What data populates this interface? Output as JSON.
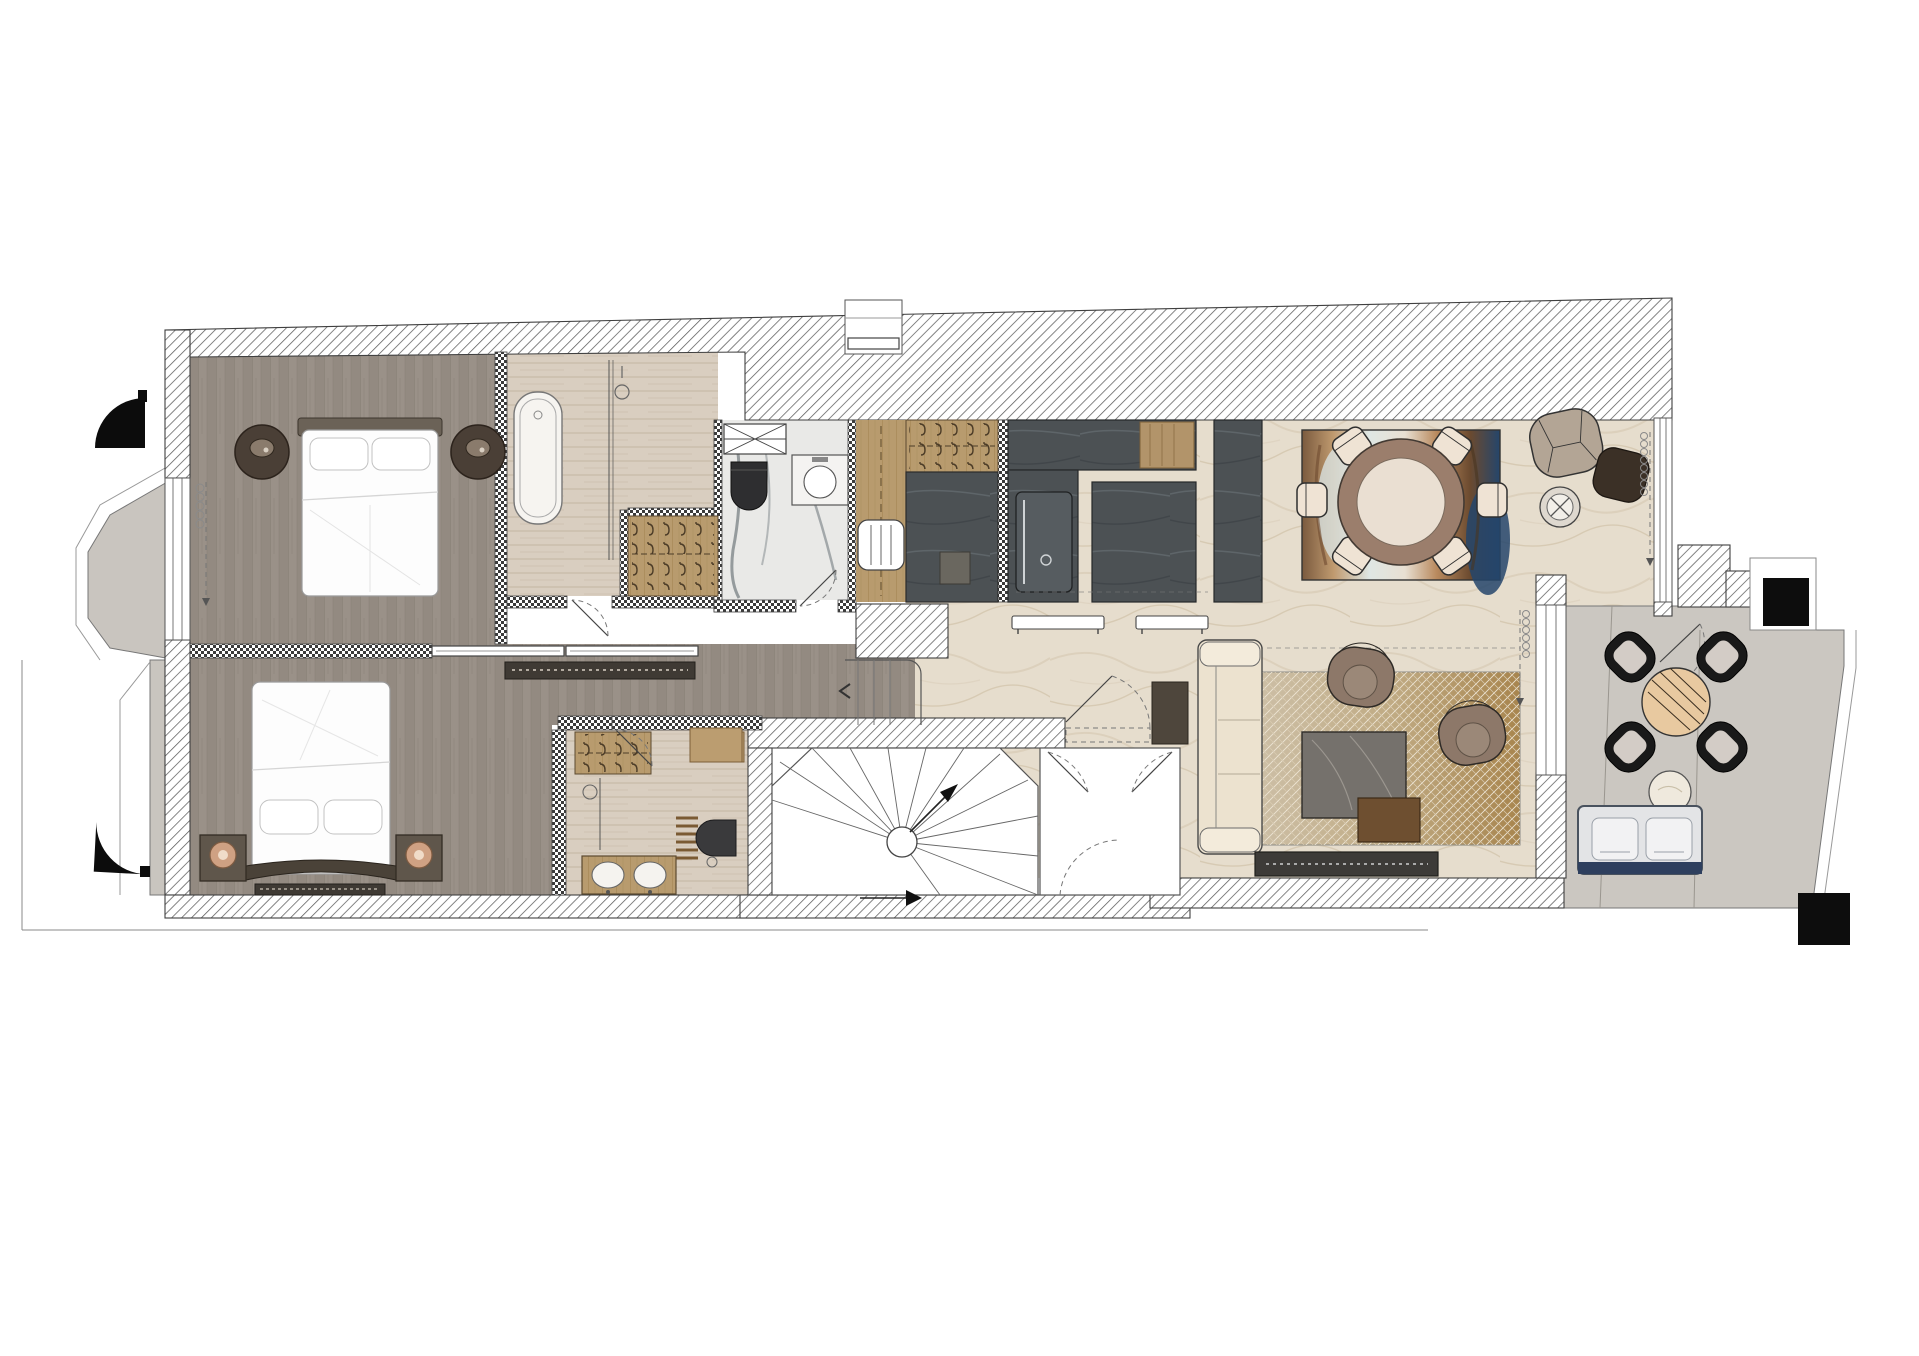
{
  "meta": {
    "title": "Furnished apartment floor plan — top-down interior design drawing",
    "type": "architectural-floor-plan",
    "visible_text": "none"
  },
  "palette": {
    "background": "#ffffff",
    "wall_hatch_line": "#5b5b5b",
    "wall_outline": "#3f3f3f",
    "oak_floor": "#9a9188",
    "oak_floor_line": "#837a71",
    "travertine": "#d9cec0",
    "marble_white": "#e9e9e7",
    "marble_vein": "#5e676d",
    "limestone_living": "#e6ddcd",
    "terrace_stone": "#cbc7c1",
    "kitchen_dark": "#4c5154",
    "closet_wood": "#b89b6e",
    "cabinet_dark": "#55524c",
    "rug_gold": "#a8854e",
    "rug_navy": "#2f4f73",
    "bench_navy": "#2e3f5e",
    "chair_cream": "#efe3d4",
    "armchair_brown": "#8d7869",
    "nightstand_brown": "#4a3f36",
    "black_elements": "#111111"
  },
  "rooms": {
    "bedroom1": {
      "label": "Bedroom 1",
      "floor": "oak planks"
    },
    "bathroom1": {
      "label": "Bathroom 1",
      "floor": "travertine"
    },
    "wardrobe1": {
      "label": "Walk-in wardrobe",
      "floor": "wood"
    },
    "wc": {
      "label": "Guest WC",
      "floor": "marble"
    },
    "entry": {
      "label": "Entrance hall",
      "floor": "wood"
    },
    "kitchen": {
      "label": "Kitchen",
      "floor": "limestone"
    },
    "dining": {
      "label": "Dining area",
      "floor": "limestone"
    },
    "lounge": {
      "label": "Reading corner",
      "floor": "limestone"
    },
    "corridor": {
      "label": "Corridor",
      "floor": "oak planks"
    },
    "bedroom2": {
      "label": "Bedroom 2",
      "floor": "oak planks"
    },
    "bathroom2": {
      "label": "Bathroom 2",
      "floor": "travertine"
    },
    "stairhall": {
      "label": "Spiral stair hall",
      "floor": "screed"
    },
    "vestibule": {
      "label": "Stair vestibule",
      "floor": "screed"
    },
    "living": {
      "label": "Living room",
      "floor": "limestone"
    },
    "terrace": {
      "label": "Terrace",
      "floor": "stone"
    },
    "bay": {
      "label": "Bay balcony",
      "floor": "stone"
    }
  },
  "furniture": {
    "bed1": "Double bed with headboard and two pillows",
    "nightstands_round": "2 round dark-wood nightstands with table lamps",
    "bathtub": "Freestanding oval bathtub",
    "shower1": "Walk-in shower with glass screen",
    "closet_hangers": "Wardrobe with clothes-hanger rows",
    "wc_radiator": "Radiator panel (X symbol)",
    "wc_toilet": "Wall-hung toilet (black)",
    "wc_basin": "Washbasin cabinet with round bowl",
    "towel_radiator": "Towel radiator (white, 3 bars)",
    "coat_closet": "Entry coat closet with hanger row",
    "entry_cabinet": "Tall dark entry cabinet",
    "kitchen_counter": "L-shaped dark stone counter with wood chopping section",
    "oven": "Built-in appliance front with handle",
    "island": "Kitchen island (dark stone)",
    "tall_cabinet": "Tall kitchen cabinet column",
    "wall_shelves": "2 white wall-mounted shelves",
    "dining_table": "Round two-tone dining table",
    "dining_chairs_count": 6,
    "dining_rug": "Abstract rug in blue / white / brown tones",
    "lounge_chair": "Curved lounge armchair (beige)",
    "ottoman": "Dark brown ottoman",
    "side_table_x": "Round side table with X-base",
    "sofa": "Three-seat cream sofa",
    "armchairs_count": 2,
    "coffee_table_marble": "Marble coffee table",
    "coffee_table_wood": "Nesting wood coffee table",
    "living_rug": "Gold cross-hatch pattern rug",
    "tv_console": "Low dark media console",
    "door_mat": "Dark door mat",
    "bed2": "King bed with curved headboard",
    "nightstands_square": "2 square nightstands with round lamps",
    "vanity2": "Double-sink wood vanity",
    "toilet2": "Wall-hung toilet (dark)",
    "towel_ladder": "Towel ladder rack",
    "trench_heater": "Floor trench heater grille",
    "console_dark": "Low dark console with ticks",
    "pocket_doors": "Double pocket sliding doors",
    "spiral_stair": "Winder spiral staircase with newel",
    "terrace_table": "Round striped-wood terrace table",
    "terrace_chairs_count": 4,
    "terrace_bench": "Outdoor bench with 2 cushions on navy base",
    "terrace_side_table": "Round outdoor side table",
    "pillar": "Structural black pillar",
    "awnings": "2 black quarter-round awning symbols"
  },
  "symbols": {
    "stair_arrow": "direction-of-travel arrow",
    "door_swing": "door leaf with dashed swing arc",
    "curtain": "coiled curtain symbol with dashed track",
    "window": "double-line glazing",
    "wall_fill_exterior": "45-degree hatch",
    "wall_fill_partition": "checkerboard"
  }
}
